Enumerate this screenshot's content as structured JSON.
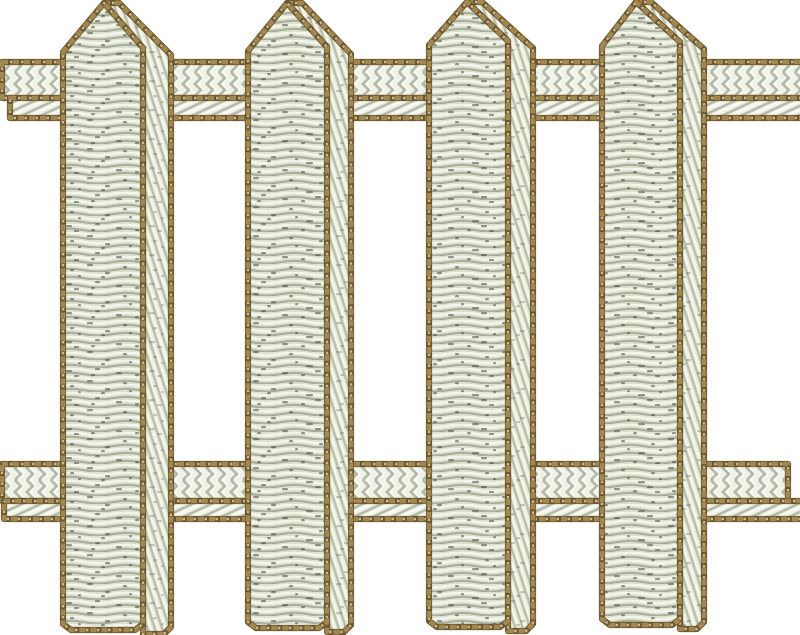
{
  "scene": {
    "type": "embroidery-design",
    "subject": "White picket fence machine embroidery design on a white background",
    "background_color": "#ffffff",
    "canvas": {
      "width": 800,
      "height": 635
    }
  },
  "palette": {
    "outline_dark": "#6e5833",
    "outline_mid": "#a0884f",
    "outline_light": "#cfb886",
    "picket_front_base": "#dde1d0",
    "picket_front_light": "#f3f4ea",
    "picket_front_shadow": "#a8af9b",
    "picket_fleck": "#44473e",
    "picket_side_base": "#eaeddd",
    "picket_side_shadow": "#b7bfa9",
    "picket_side_light": "#f6f7ee",
    "rail_base": "#f0f2e6",
    "rail_shadow": "#b3bba8",
    "rail_highlight": "#ffffff"
  },
  "fence": {
    "picket_count": 4,
    "rail_count": 2,
    "rails": [
      {
        "name": "top-rail",
        "top": 62,
        "divider": 98,
        "bottom": 118,
        "upper": {
          "x1": 2,
          "x2": 800,
          "cap_left": true,
          "cap_right": false
        },
        "lower": {
          "x1": 10,
          "x2": 800,
          "cap_left": true,
          "cap_right": false
        }
      },
      {
        "name": "bottom-rail",
        "top": 464,
        "divider": 501,
        "bottom": 519,
        "upper": {
          "x1": 2,
          "x2": 788,
          "cap_left": true,
          "cap_right": true
        },
        "lower": {
          "x1": 4,
          "x2": 800,
          "cap_left": true,
          "cap_right": false
        }
      }
    ],
    "pickets": [
      {
        "name": "picket-1",
        "front_left": 63,
        "front_right": 143,
        "side_right": 171,
        "apex_x": 104,
        "apex_y": 3,
        "shoulder_y": 52,
        "bottom": 630
      },
      {
        "name": "picket-2",
        "front_left": 248,
        "front_right": 327,
        "side_right": 351,
        "apex_x": 287,
        "apex_y": 3,
        "shoulder_y": 51,
        "bottom": 628
      },
      {
        "name": "picket-3",
        "front_left": 429,
        "front_right": 508,
        "side_right": 533,
        "apex_x": 467,
        "apex_y": 2,
        "shoulder_y": 45,
        "bottom": 627
      },
      {
        "name": "picket-4",
        "front_left": 602,
        "front_right": 680,
        "side_right": 704,
        "apex_x": 636,
        "apex_y": 2,
        "shoulder_y": 46,
        "bottom": 625
      }
    ]
  }
}
